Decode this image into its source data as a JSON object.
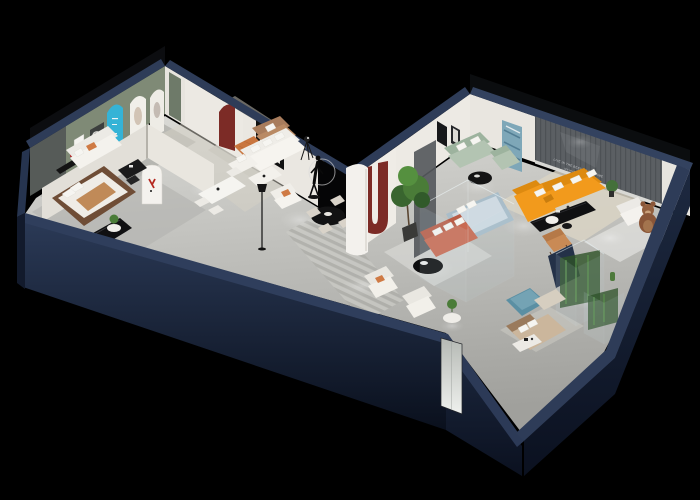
{
  "meta": {
    "title": "3D isometric furniture showroom floor plan render",
    "render_type": "dollhouse cutaway axonometric view",
    "canvas": {
      "width": 700,
      "height": 500
    }
  },
  "wall_text": {
    "line1": "LIVE IN THE BEST OF THE TIME",
    "line2": "MY WARM HOUSE"
  },
  "colors": {
    "background": "#000000",
    "wall_top": "#2e3c58",
    "wall_top_light": "#33425f",
    "wall_face": "#223049",
    "wall_face_dark": "#141d2e",
    "floor_light": "#d8d8d4",
    "floor_mid": "#a2a29e",
    "interior_wall": "#eae7e1",
    "sage_wall": "#7f8a76",
    "slat_wall": "#5b5f63",
    "black_opening": "#050506",
    "accent_orange": "#f29a1c",
    "accent_terracotta": "#bd5f49",
    "accent_caramel": "#c9763f",
    "accent_red_arch": "#7c2b26",
    "accent_cyan": "#35b3d6",
    "accent_sage_sofa": "#b3c4b2",
    "accent_teal": "#5b8fa3",
    "bed_blue": "#a9bdc9",
    "bear_brown": "#8a5638",
    "plant_green": "#4a7c38",
    "console_black": "#101012",
    "text_light": "#d8dadc"
  },
  "rooms": [
    {
      "name": "left-bedroom-display",
      "furniture": [
        "wood-frame bed with caramel throw",
        "black wall shelf with red decor",
        "black credenza",
        "round side table with plant",
        "white wardrobe door"
      ]
    },
    {
      "name": "green-lounge",
      "furniture": [
        "white sofa with orange pillow",
        "black desk with chair",
        "white framed print",
        "dark framed swirl art",
        "sage accent wall"
      ]
    },
    {
      "name": "arch-gallery-corridor",
      "furniture": [
        "cyan arch display",
        "two white arch displays",
        "green door panel",
        "tan loveseat",
        "caramel leather ottoman",
        "round white coffee table",
        "striped grey rug",
        "white pillar with red logo"
      ]
    },
    {
      "name": "center-living-area",
      "furniture": [
        "white corner sectional with pillows",
        "white coffee table",
        "black framed artwork",
        "dark red arch niche",
        "white dining table with chairs",
        "black round dining table with four cream chairs",
        "white armchair with orange pillow",
        "black floor lamp",
        "mannequin sculpture with ring light",
        "tripod spotlight",
        "white curved partition",
        "red U arch niche",
        "large potted tree",
        "black oval coffee table",
        "two cream armchairs",
        "round table with plant",
        "striped runner rug"
      ]
    },
    {
      "name": "green-sofa-lounge",
      "furniture": [
        "sage green sofa",
        "sage green armchair",
        "black round coffee table",
        "two black framed prints",
        "tall blue abstract artwork"
      ]
    },
    {
      "name": "glass-bedroom-display",
      "furniture": [
        "glass partition box",
        "light blue bed with white pillows",
        "terracotta sofa with white pillows",
        "dark feature panel"
      ]
    },
    {
      "name": "orange-showroom",
      "furniture": [
        "orange L-shaped sectional with white pillows",
        "black media console",
        "white round coffee table",
        "black round side table",
        "white armchair",
        "teddy bear chair",
        "tan accent chair",
        "cream rug",
        "dark slat feature wall with slogan",
        "plant"
      ]
    },
    {
      "name": "bottom-display-corner",
      "furniture": [
        "two glass display cases with green plants",
        "cactus",
        "tan display bed",
        "teal ottoman",
        "beige chaise",
        "white shelf table",
        "round table with plant",
        "mirror door panel on facade"
      ]
    }
  ]
}
